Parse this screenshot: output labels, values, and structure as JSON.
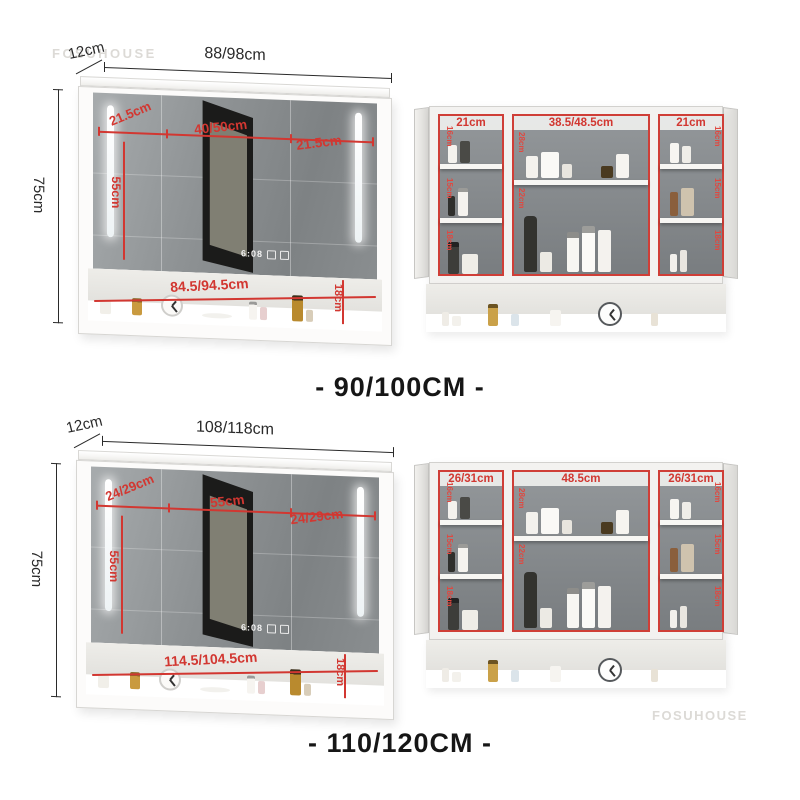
{
  "watermarks": {
    "top_left": "FOSUHOUSE",
    "bottom_right": "FOSUHOUSE"
  },
  "colors": {
    "dimension_red": "#d23731",
    "dimension_black": "#2a2a2a",
    "caption": "#161616"
  },
  "sections": [
    {
      "caption": "- 90/100CM -",
      "closed_cabinet": {
        "depth_label": "12cm",
        "width_label": "88/98cm",
        "height_label": "75cm",
        "door_left_label": "21.5cm",
        "door_center_label": "40/50cm",
        "door_right_label": "21.5cm",
        "led_height_label": "55cm",
        "shelf_width_label": "84.5/94.5cm",
        "shelf_height_label": "18cm",
        "mirror_display": {
          "time": "6:08",
          "icons": [
            "square-touch-button",
            "square-touch-button"
          ]
        }
      },
      "open_cabinet": {
        "left_width_label": "21cm",
        "center_width_label": "38.5/48.5cm",
        "right_width_label": "21cm",
        "left_heights": [
          "16cm",
          "15cm",
          "18cm"
        ],
        "center_heights": [
          "28cm",
          "22cm"
        ],
        "right_heights": [
          "16cm",
          "15cm",
          "18cm"
        ]
      }
    },
    {
      "caption": "- 110/120CM -",
      "closed_cabinet": {
        "depth_label": "12cm",
        "width_label": "108/118cm",
        "height_label": "75cm",
        "door_left_label": "24/29cm",
        "door_center_label": "55cm",
        "door_right_label": "24/29cm",
        "led_height_label": "55cm",
        "shelf_width_label": "114.5/104.5cm",
        "shelf_height_label": "18cm",
        "mirror_display": {
          "time": "6:08",
          "icons": [
            "square-touch-button",
            "square-touch-button"
          ]
        }
      },
      "open_cabinet": {
        "left_width_label": "26/31cm",
        "center_width_label": "48.5cm",
        "right_width_label": "26/31cm",
        "left_heights": [
          "16cm",
          "15cm",
          "18cm"
        ],
        "center_heights": [
          "28cm",
          "22cm"
        ],
        "right_heights": [
          "16cm",
          "15cm",
          "18cm"
        ]
      }
    }
  ]
}
